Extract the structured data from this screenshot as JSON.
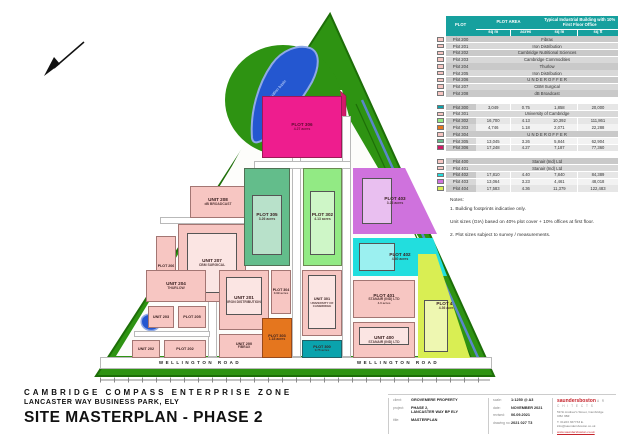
{
  "header_table": {
    "columns": {
      "plot": "PLOT",
      "area": "PLOT AREA",
      "building": "Typical Industrial Building with 10% First Floor Office"
    },
    "units": {
      "u0": "sq m",
      "u1": "acres",
      "u2": "sq m",
      "u3": "sq ft"
    },
    "groups": [
      {
        "rows": [
          {
            "c": "#f7c6c2",
            "p": "Plot 200",
            "m": "Fibrax"
          },
          {
            "c": "#f7c6c2",
            "p": "Plot 201",
            "m": "Iron Distribution"
          },
          {
            "c": "#f7c6c2",
            "p": "Plot 202",
            "m": "Cambridge Nutritional Sciences"
          },
          {
            "c": "#f7c6c2",
            "p": "Plot 203",
            "m": "Cambridge Commodities"
          },
          {
            "c": "#f7c6c2",
            "p": "Plot 204",
            "m": "Thurlow"
          },
          {
            "c": "#f7c6c2",
            "p": "Plot 205",
            "m": "Iron Distribution"
          },
          {
            "c": "#f7c6c2",
            "p": "Plot 206",
            "m": "U N D E R   O F F E R"
          },
          {
            "c": "#f7c6c2",
            "p": "Plot 207",
            "m": "CBM Surgical"
          },
          {
            "c": "#f7c6c2",
            "p": "Plot 208",
            "m": "dB Broadcast"
          }
        ]
      },
      {
        "rows": [
          {
            "c": "#0aa3ad",
            "p": "Plot 300",
            "v": [
              "3,049",
              "0.75",
              "1,858",
              "20,000"
            ]
          },
          {
            "c": "#f7c6c2",
            "p": "Plot 301",
            "m": "University of Cambridge"
          },
          {
            "c": "#92ea84",
            "p": "Plot 302",
            "v": [
              "16,700",
              "4.13",
              "10,392",
              "111,861"
            ]
          },
          {
            "c": "#e5761e",
            "p": "Plot 303",
            "v": [
              "4,746",
              "1.18",
              "2,071",
              "22,288"
            ]
          },
          {
            "c": "#f7c6c2",
            "p": "Plot 304",
            "m": "U N D E R   O F F E R"
          },
          {
            "c": "#63bd8b",
            "p": "Plot 305",
            "v": [
              "13,045",
              "3.26",
              "5,844",
              "62,904"
            ]
          },
          {
            "c": "#cf1a66",
            "p": "Plot 306",
            "v": [
              "17,248",
              "4.27",
              "7,187",
              "77,360"
            ]
          }
        ]
      },
      {
        "rows": [
          {
            "c": "#f7c6c2",
            "p": "Plot 400",
            "m": "Stanair (Ind) Ltd"
          },
          {
            "c": "#f7c6c2",
            "p": "Plot 401",
            "m": "Stanair (Ind) Ltd"
          },
          {
            "c": "#22dede",
            "p": "Plot 402",
            "v": [
              "17,810",
              "4.40",
              "7,840",
              "84,389"
            ]
          },
          {
            "c": "#cf72dd",
            "p": "Plot 403",
            "v": [
              "13,064",
              "3.23",
              "4,461",
              "48,018"
            ]
          },
          {
            "c": "#d9ee53",
            "p": "Plot 404",
            "v": [
              "17,583",
              "4.36",
              "11,379",
              "122,483"
            ]
          }
        ]
      }
    ]
  },
  "notes": {
    "title": "Notes:",
    "n1": "1. Building footprints indicative only.",
    "n2": "Unit sizes (GIA) based on 40% plot cover + 10% offices at first floor.",
    "n3": "2. Plot sizes subject to survey / measurements."
  },
  "plan": {
    "road_label": "WELLINGTON ROAD",
    "pond_label": "attenuation basin",
    "plots": {
      "u208": {
        "t": "UNIT 208",
        "s": "dB BROADCAST"
      },
      "u207": {
        "t": "UNIT 207",
        "s": "CBM SURGICAL"
      },
      "p206": {
        "t": "PLOT 206"
      },
      "u204": {
        "t": "UNIT 204",
        "s": "THURLOW"
      },
      "u203": {
        "t": "UNIT 203"
      },
      "p205": {
        "t": "PLOT 205"
      },
      "u202": {
        "t": "UNIT 202"
      },
      "p202": {
        "t": "PLOT 202"
      },
      "u201": {
        "t": "UNIT 201",
        "s": "IRON DISTRIBUTION"
      },
      "u200": {
        "t": "UNIT 200",
        "s": "FIBRAX"
      },
      "p304": {
        "t": "PLOT 304",
        "s": "0.99 acres"
      },
      "p303": {
        "t": "PLOT 303",
        "s": "1.18 acres"
      },
      "u301": {
        "t": "UNIT 301",
        "s": "UNIVERSITY OF CAMBRIDGE"
      },
      "p300": {
        "t": "PLOT 300",
        "s": "0.75 acres"
      },
      "p306": {
        "t": "PLOT 306",
        "s": "4.27 acres"
      },
      "p305": {
        "t": "PLOT 305",
        "s": "3.26 acres"
      },
      "p302": {
        "t": "PLOT 302",
        "s": "4.13 acres"
      },
      "p403": {
        "t": "PLOT 403",
        "s": "3.23 acres"
      },
      "p402": {
        "t": "PLOT 402",
        "s": "4.40 acres"
      },
      "p401": {
        "t": "PLOT 401",
        "s": "STANAIR (IND) LTD",
        "s2": "4.0 acres"
      },
      "u400": {
        "t": "UNIT 400",
        "s": "STANAIR (IND) LTD"
      },
      "p404": {
        "t": "PLOT 404",
        "s": "4.36 acres"
      }
    }
  },
  "titleblock": {
    "zone": "CAMBRIDGE COMPASS ENTERPRISE ZONE",
    "park": "LANCASTER WAY BUSINESS PARK, ELY",
    "title": "SITE MASTERPLAN - PHASE 2",
    "client_label": "client:",
    "client": "GROVEMERE PROPERTY",
    "project_label": "project:",
    "project1": "PHASE 2,",
    "project2": "LANCASTER WAY BP ELY",
    "sheet_label": "title:",
    "sheet_title": "MASTERPLAN",
    "scale_label": "scale:",
    "scale": "1:1250 @ A3",
    "date_label": "date:",
    "date": "NOVEMBER 2021",
    "revised_label": "revised:",
    "revised": "06.09.2021",
    "drawing_label": "drawing no:",
    "drawing": "2021 027 T3",
    "architect": {
      "brand": "saundersboston",
      "suffix": "A R C H I T E C T S",
      "addr1": "59 St Andrew's Street, Cambridge CB2 3BZ",
      "addr2": "T. 01223 367733   E. info@saundersboston.co.uk",
      "web": "www.saundersboston.co.uk"
    }
  }
}
